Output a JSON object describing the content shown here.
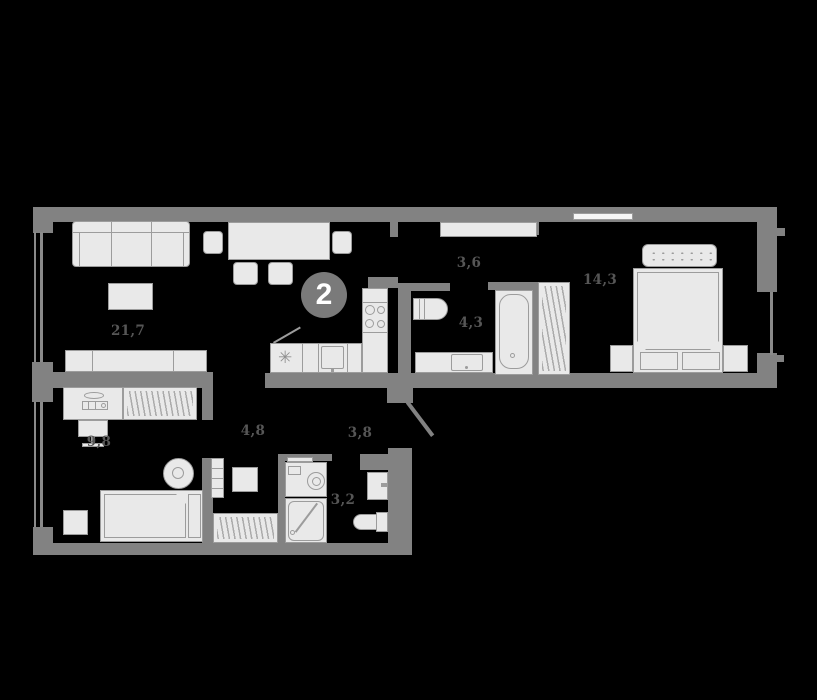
{
  "unit_badge": {
    "label": "2"
  },
  "rooms": [
    {
      "id": "living-room",
      "area": "21,7"
    },
    {
      "id": "hallway-top",
      "area": "3,6"
    },
    {
      "id": "bathroom-main",
      "area": "4,3"
    },
    {
      "id": "bedroom-main",
      "area": "14,3"
    },
    {
      "id": "bedroom-second",
      "area": "9,8"
    },
    {
      "id": "hallway-lower",
      "area": "4,8"
    },
    {
      "id": "entry-corridor",
      "area": "3,8"
    },
    {
      "id": "bathroom-second",
      "area": "3,2"
    }
  ],
  "icons": {
    "fridge_snowflake": "✳"
  },
  "colors": {
    "background": "#000000",
    "wall": "#828282",
    "furniture_fill": "#e9e9e9",
    "furniture_stroke": "#9c9c9c",
    "label_text": "#565656",
    "badge_fill": "#7a7a7a",
    "badge_text": "#ffffff"
  }
}
